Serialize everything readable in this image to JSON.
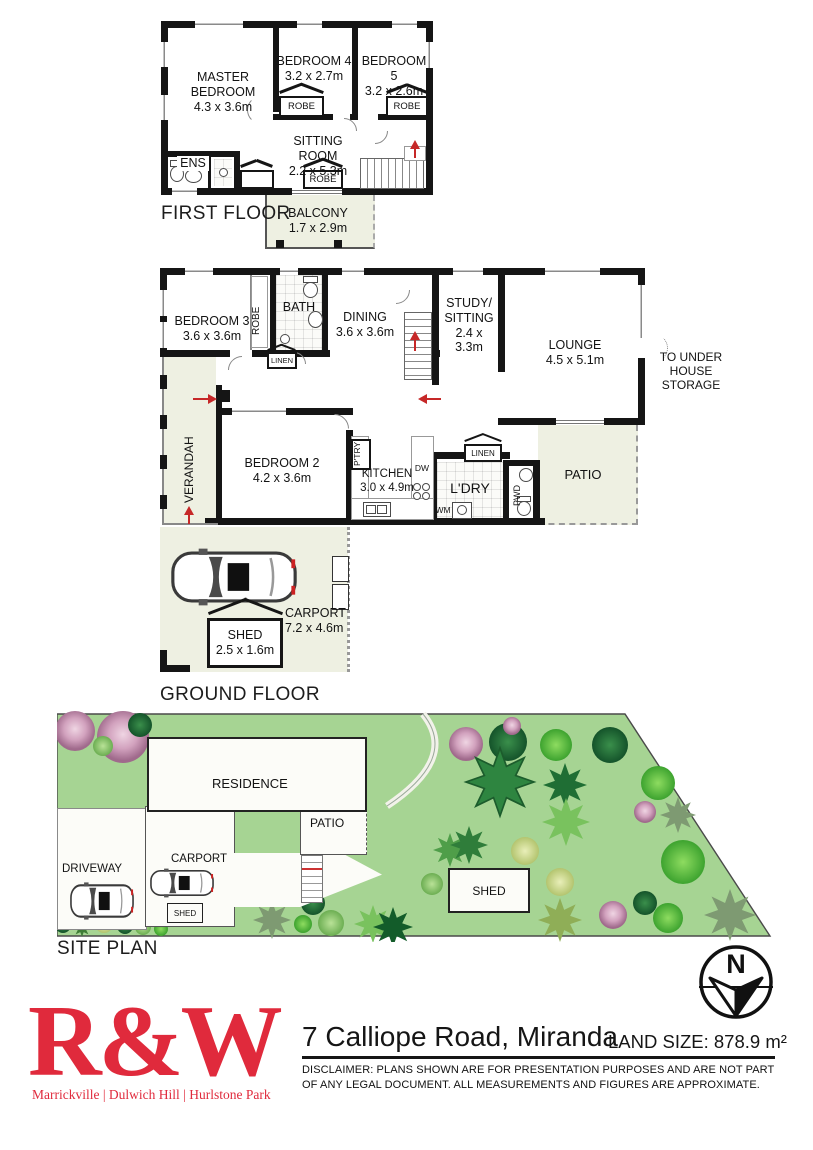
{
  "colors": {
    "brand_red": "#E02A3C",
    "grass_green": "#A6D493",
    "wall_black": "#151515",
    "outdoor_fill": "#EEF0E2",
    "arrow_red": "#C62828"
  },
  "ff": {
    "title": "FIRST FLOOR",
    "master": {
      "name": "MASTER BEDROOM",
      "dims": "4.3 x 3.6m"
    },
    "bed4": {
      "name": "BEDROOM 4",
      "dims": "3.2 x 2.7m"
    },
    "bed5": {
      "name": "BEDROOM 5",
      "dims": "3.2 x 2.6m"
    },
    "sitting": {
      "name": "SITTING ROOM",
      "dims": "2.2 x 5.3m"
    },
    "balcony": {
      "name": "BALCONY",
      "dims": "1.7 x 2.9m"
    },
    "ens": "ENS",
    "robe": "ROBE"
  },
  "gf": {
    "title": "GROUND FLOOR",
    "bed3": {
      "name": "BEDROOM 3",
      "dims": "3.6 x 3.6m"
    },
    "bath": "BATH",
    "robe": "ROBE",
    "linen": "LINEN",
    "dining": {
      "name": "DINING",
      "dims": "3.6 x 3.6m"
    },
    "study": {
      "name1": "STUDY/",
      "name2": "SITTING",
      "dims": "2.4 x 3.3m"
    },
    "lounge": {
      "name": "LOUNGE",
      "dims": "4.5 x 5.1m"
    },
    "storage": {
      "l1": "TO UNDER",
      "l2": "HOUSE",
      "l3": "STORAGE"
    },
    "verandah": "VERANDAH",
    "bed2": {
      "name": "BEDROOM 2",
      "dims": "4.2 x 3.6m"
    },
    "kitchen": {
      "name": "KITCHEN",
      "dims": "3.0 x 4.9m"
    },
    "pantry": "P'TRY",
    "dw": "DW",
    "wm": "WM",
    "ldry": "L'DRY",
    "pwd": "PWD",
    "patio": "PATIO",
    "carport": {
      "name": "CARPORT",
      "dims": "7.2 x 4.6m"
    },
    "shed": {
      "name": "SHED",
      "dims": "2.5 x 1.6m"
    }
  },
  "site": {
    "title": "SITE PLAN",
    "residence": "RESIDENCE",
    "patio": "PATIO",
    "carport": "CARPORT",
    "driveway": "DRIVEWAY",
    "shed": "SHED",
    "garden_shed": "SHED"
  },
  "compass": {
    "north": "N"
  },
  "footer": {
    "logo": "R&W",
    "offices": "Marrickville | Dulwich Hill | Hurlstone Park",
    "address": "7 Calliope Road, Miranda",
    "land_size": "LAND SIZE: 878.9 m²",
    "disclaimer1": "DISCLAIMER:  PLANS SHOWN ARE FOR PRESENTATION PURPOSES AND ARE NOT PART",
    "disclaimer2": "OF ANY LEGAL DOCUMENT. ALL MEASUREMENTS AND FIGURES ARE APPROXIMATE."
  }
}
